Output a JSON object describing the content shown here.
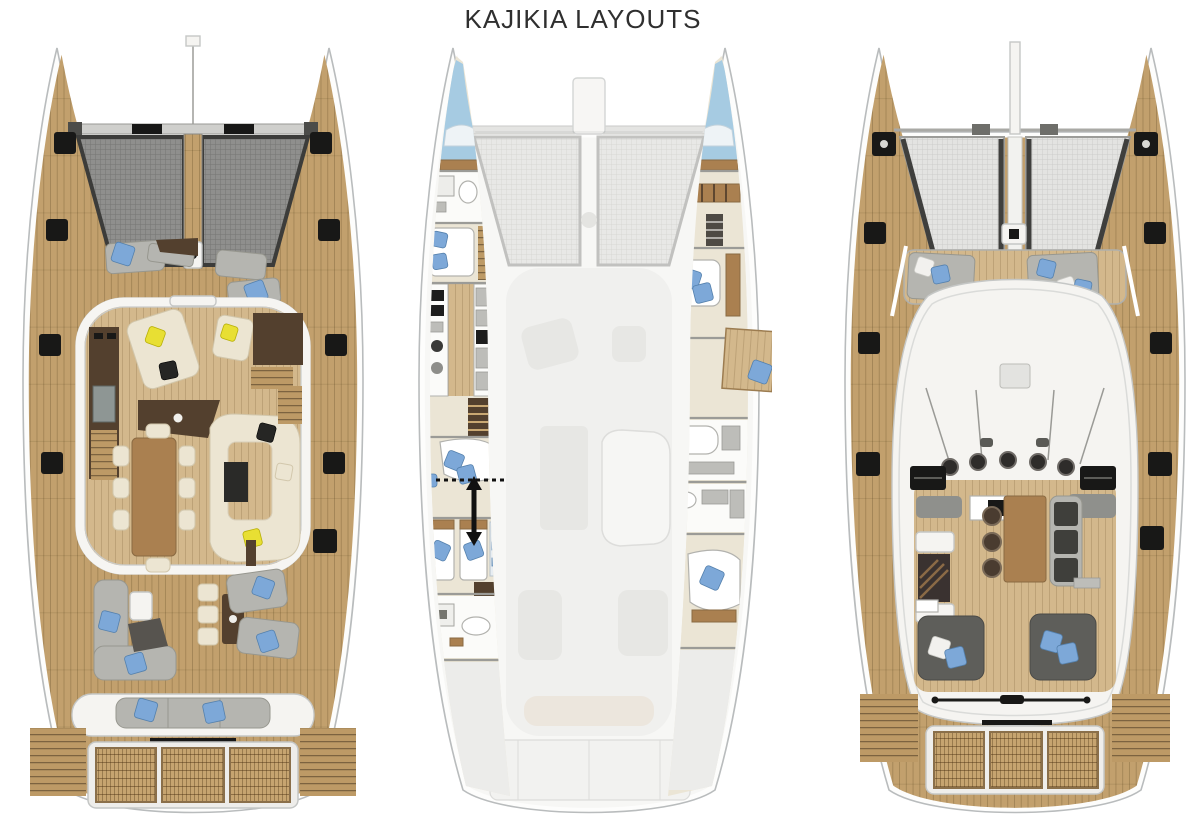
{
  "page": {
    "title": "KAJIKIA LAYOUTS"
  },
  "layouts": [
    {
      "id": "main-deck-saloon",
      "position": "left"
    },
    {
      "id": "lower-deck-cabins",
      "position": "center"
    },
    {
      "id": "flybridge-deck",
      "position": "right"
    }
  ],
  "colors": {
    "background": "#ffffff",
    "title_text": "#2f2f2f",
    "hull_fill": "#fdfdfc",
    "hull_outline": "#b9bcbd",
    "teak_deck": "#c2a06d",
    "teak_light": "#d3b88c",
    "dark_wood": "#53402e",
    "mid_wood": "#aa8050",
    "cream_upholstery": "#ece5d2",
    "gray_upholstery": "#b5b5b0",
    "charcoal": "#5e5e5a",
    "blue_cushion": "#7da8d8",
    "yellow_cushion": "#e8df33",
    "white_structure": "#f5f4f1",
    "trampoline_dark": "#8f8f8d",
    "trampoline_light": "#e2e2e0",
    "black_detail": "#181817"
  }
}
